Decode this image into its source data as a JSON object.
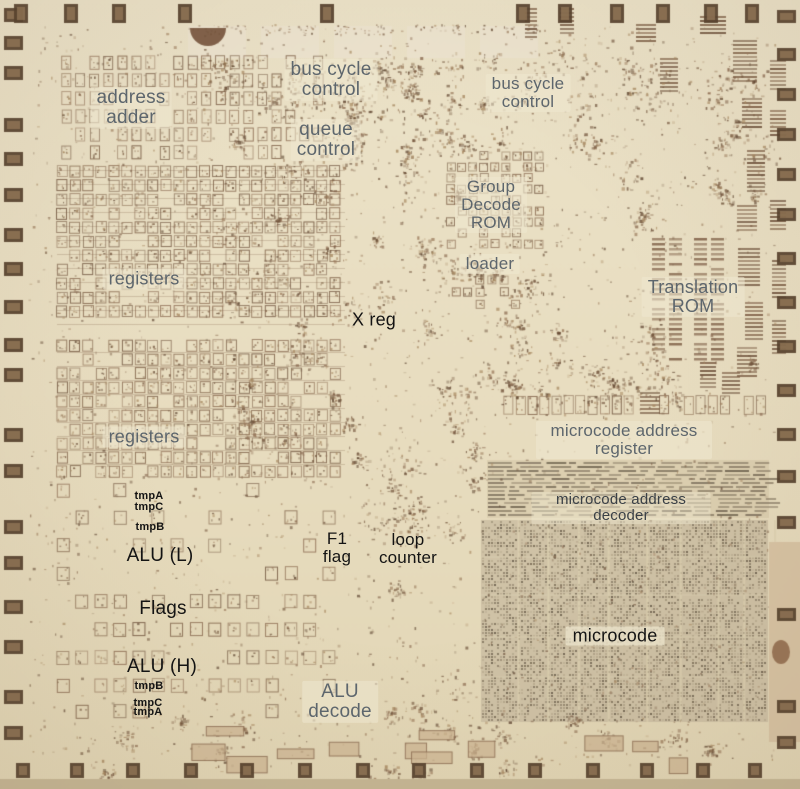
{
  "colors": {
    "die_background": "#e6dcbf",
    "circuit_brown": "#8a6a50",
    "microcode_rom_gray": "#8d8069",
    "label_gray": "#5d666d",
    "label_dark": "#3a4046",
    "label_black": "#141414"
  },
  "labels": [
    {
      "id": "address-adder",
      "text": "address\nadder"
    },
    {
      "id": "bus-cycle-control-top",
      "text": "bus cycle\ncontrol"
    },
    {
      "id": "queue-control",
      "text": "queue\ncontrol"
    },
    {
      "id": "bus-cycle-control-right",
      "text": "bus cycle\ncontrol"
    },
    {
      "id": "group-decode-rom",
      "text": "Group\nDecode\nROM"
    },
    {
      "id": "loader",
      "text": "loader"
    },
    {
      "id": "translation-rom",
      "text": "Translation\nROM"
    },
    {
      "id": "x-reg",
      "text": "X reg"
    },
    {
      "id": "registers-upper",
      "text": "registers"
    },
    {
      "id": "registers-lower",
      "text": "registers"
    },
    {
      "id": "microcode-address-register",
      "text": "microcode address register"
    },
    {
      "id": "microcode-address-decoder",
      "text": "microcode address decoder"
    },
    {
      "id": "tmpA-upper",
      "text": "tmpA"
    },
    {
      "id": "tmpC-upper",
      "text": "tmpC"
    },
    {
      "id": "tmpB-upper",
      "text": "tmpB"
    },
    {
      "id": "alu-l",
      "text": "ALU (L)"
    },
    {
      "id": "f1-flag",
      "text": "F1\nflag"
    },
    {
      "id": "loop-counter",
      "text": "loop\ncounter"
    },
    {
      "id": "flags",
      "text": "Flags"
    },
    {
      "id": "alu-h",
      "text": "ALU (H)"
    },
    {
      "id": "tmpB-lower",
      "text": "tmpB"
    },
    {
      "id": "tmpC-lower",
      "text": "tmpC"
    },
    {
      "id": "tmpA-lower",
      "text": "tmpA"
    },
    {
      "id": "alu-decode",
      "text": "ALU\ndecode"
    },
    {
      "id": "microcode",
      "text": "microcode"
    }
  ]
}
